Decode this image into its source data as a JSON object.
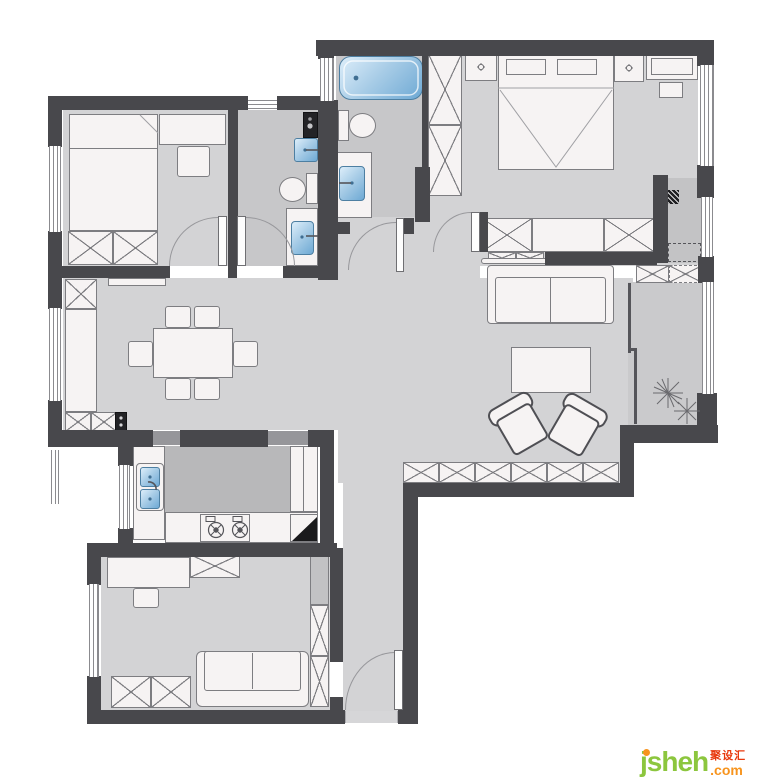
{
  "watermark": {
    "brand": "jsheh",
    "suffix": ".com",
    "cjk": "聚设汇",
    "brand_color": "#8CC63E",
    "suffix_color": "#F7941E",
    "cjk_color": "#E8380D"
  },
  "palette": {
    "wall": "#48484c",
    "floor": "#d3d3d5",
    "floor-wet": "#c7c7c9",
    "floor-balcony": "#cacacc",
    "floor-kitchen-worktop": "#b8b8ba",
    "floor-foyer": "#c3c3c5",
    "furniture-fill": "#f6f3f3",
    "furniture-line": "#7d7d81",
    "water-blue-light": "#ddeefa",
    "water-blue-dark": "#6ea9d4",
    "door-arc": "#97979b",
    "threshold": "#96969a",
    "brand-color": "#8CC63E",
    "suffix-color": "#F7941E",
    "cjk-color": "#E8380D",
    "background": "#ffffff"
  },
  "inventory": {
    "rooms": [
      "bedroom-top-left",
      "inner-bathroom",
      "master-bathroom",
      "master-bedroom",
      "entry-foyer-niche",
      "living-room",
      "dining-room",
      "balcony",
      "kitchen",
      "study-bedroom",
      "hallway",
      "entry-corridor"
    ],
    "fixtures": [
      "double-bed",
      "desk",
      "desk-chair",
      "wardrobe",
      "washing-machine",
      "washbasin",
      "toilet",
      "bathtub",
      "nightstand",
      "dresser",
      "stool",
      "sofa",
      "coffee-table",
      "lounge-chair",
      "tv-cabinet",
      "dining-table",
      "dining-chair",
      "sideboard",
      "shoe-cabinet",
      "kitchen-sink",
      "gas-stove",
      "refrigerator-corner",
      "plant",
      "entry-door"
    ]
  }
}
